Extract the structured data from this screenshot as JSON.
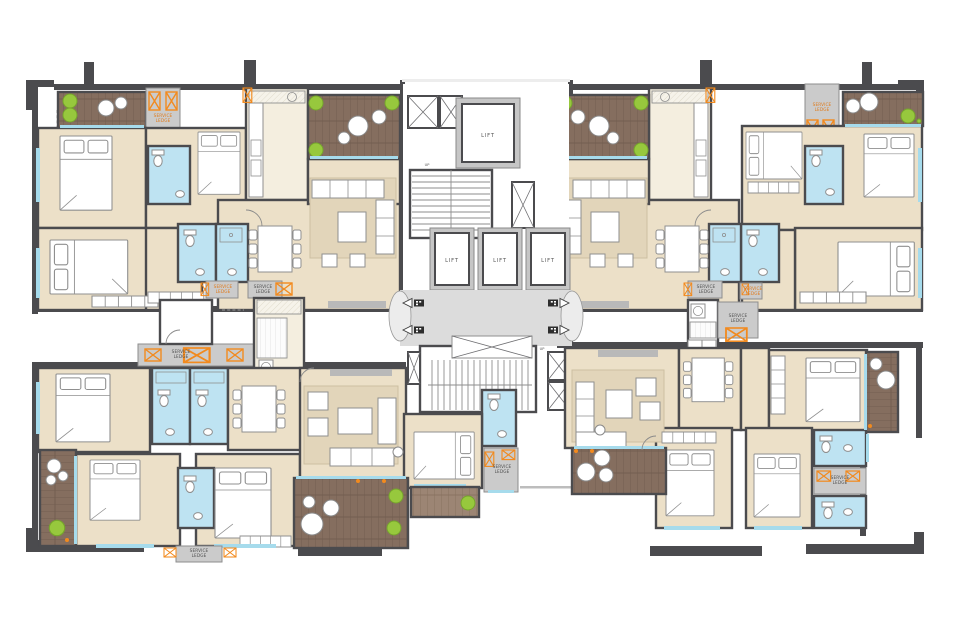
{
  "plan": {
    "labels": {
      "lift": "LIFT",
      "up": "UP",
      "service": "SERVICE",
      "ledge": "LEDGE"
    }
  },
  "colors": {
    "wall": "#4b4b4e",
    "floor": "#ece0c8",
    "floorlight": "#f4eedf",
    "bath": "#bee3f2",
    "lobby": "#dcdcdc",
    "ledge": "#cbcbcb",
    "deck": "#856e5f",
    "decklight": "#9c8574",
    "plank": "#6f5a4d",
    "plant": "#97c83d",
    "plantedge": "#76a52c",
    "orange": "#f28a1e",
    "window": "#a6dbec",
    "rug": "#e2d5ba",
    "rugedge": "#cdbfa2",
    "furn": "#8f8f8f",
    "text": "#4f4f4f",
    "textorange": "#e07a1a",
    "liftframe": "#c6c6c6"
  }
}
